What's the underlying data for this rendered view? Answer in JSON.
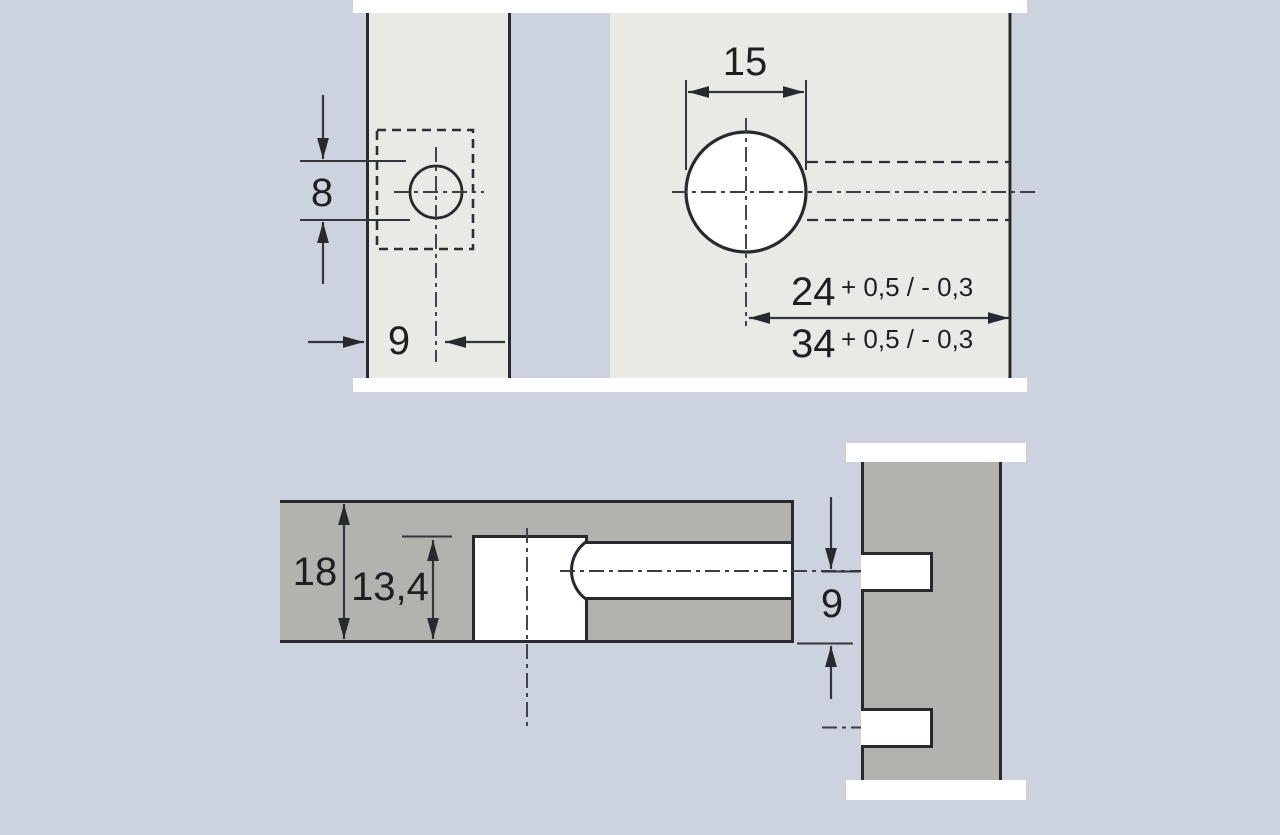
{
  "drawing_title": "furniture-connector-drilling-dimensions",
  "colors": {
    "background": "#ccd3de",
    "panel_light": "#e9eae6",
    "board_gray": "#b2b3ae",
    "break_white": "#ffffff",
    "line_dark": "#27292e"
  },
  "top_view": {
    "edge_hole_diameter": "8",
    "edge_hole_distance": "9",
    "face_hole_diameter": "15",
    "distance_option_1": "24",
    "tolerance_1": "+ 0,5 / - 0,3",
    "distance_option_2": "34",
    "tolerance_2": "+ 0,5 / - 0,3"
  },
  "section_view": {
    "board_thickness": "18",
    "hole_depth": "13,4",
    "dowel_axis_distance": "9"
  }
}
